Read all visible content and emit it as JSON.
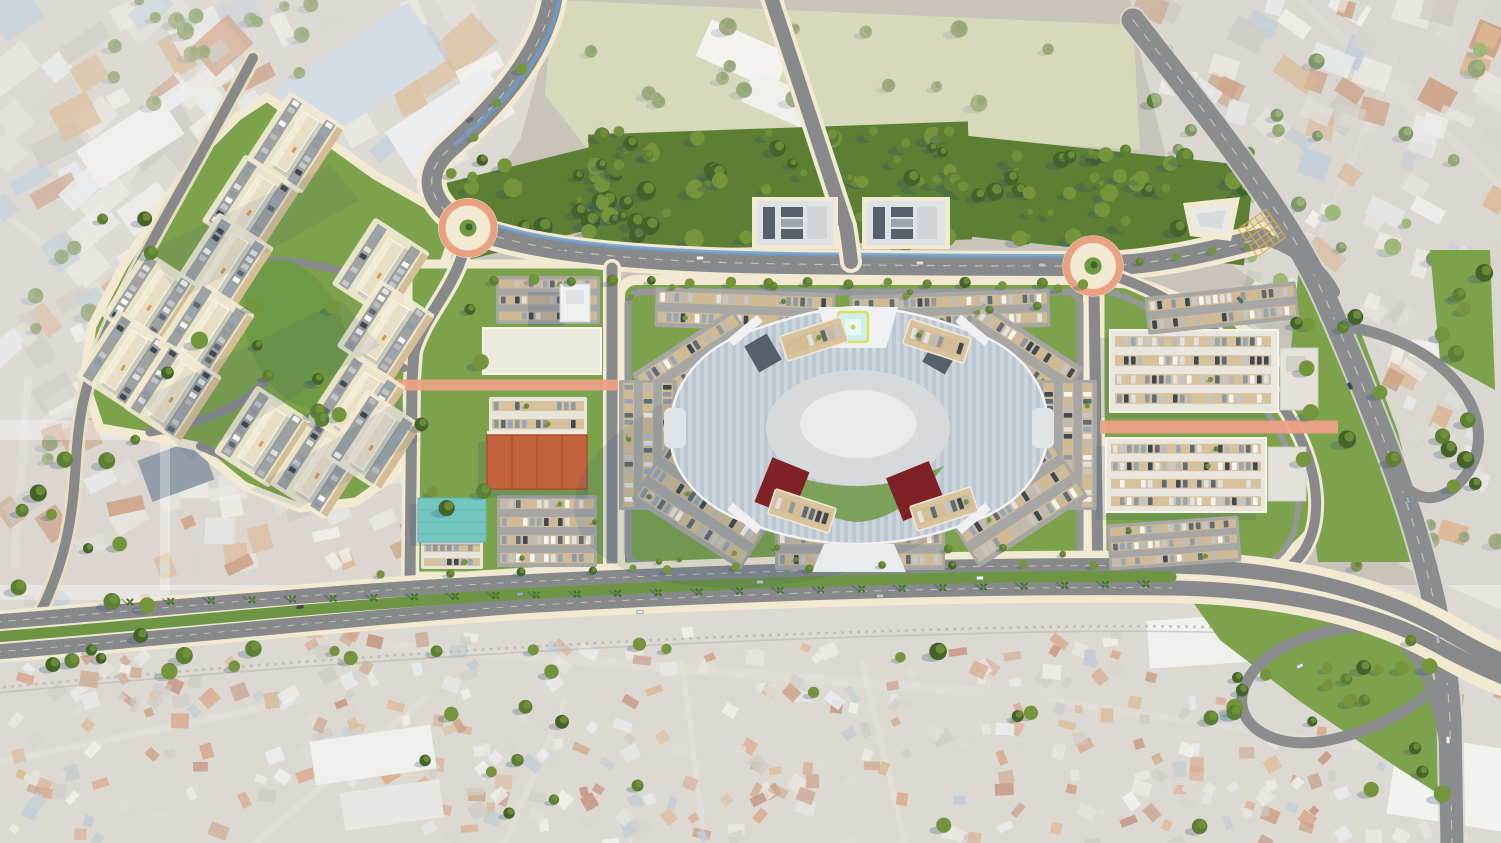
{
  "scene": {
    "title": "Aerial masterplan rendering of a mixed-use retail and residential development",
    "type": "3d-render-site-plan",
    "view": "top-down aerial",
    "no_visible_text": true,
    "width": 1501,
    "height": 843
  },
  "palette": {
    "base": "#c9c4ba",
    "field": "#c6cb9d",
    "lawn": "#7ca24b",
    "lawnDark": "#6f9a45",
    "median": "#6d9544",
    "forestFloor": "#5d7f33",
    "cream": "#f1e9d2",
    "creamSoft": "#e9dfc2",
    "asphalt": "#87898b",
    "asphaltLight": "#95979a",
    "asphaltDark": "#797b7e",
    "highway": "#8a8c8e",
    "roadEdge": "#d8d8d4",
    "cycleBlue": "#6f9cc9",
    "roundRing": "#e9a181",
    "salmon": "#eba184",
    "parkAsphalt": "#a6a7a5",
    "stallTan": "#d4bd94",
    "deckTan": "#d8c49c",
    "mallStripeA": "#bcc6d0",
    "mallStripeB": "#cdd5dc",
    "mallParapet": "#f0f2f4",
    "courtyard": "#d7dadd",
    "courtyardLight": "#e9eaec",
    "entryWhite": "#eef0f2",
    "redAnchor": "#7e2125",
    "slateRoof": "#55606b",
    "slateLight": "#7b8691",
    "tealRoof": "#74c7c1",
    "bigboxOrange": "#c2633e",
    "bigboxRidge": "#a94f30",
    "whiteBldg": "#eceada",
    "whiteRoof": "#e8e6df",
    "beigeBldg": "#e8dec6",
    "beigeLight": "#f2ebd8",
    "plotBldg": "#dfe2e4",
    "helipadTeal": "#cdeeea",
    "helipadYellow": "#d9e05e",
    "shadow": "#2d4b73",
    "hazeWhite": "#ffffff",
    "rail": "#8a8a82",
    "hatchYellow": "#d4b04e",
    "existRoad": "#d9d6ce",
    "treeForest1": "#44632a",
    "treeForest2": "#5d7f33",
    "treeForest3": "#74953c",
    "treeOlive1": "#6b7a3a",
    "treeOlive2": "#7d8a4e",
    "palmGreen": "#3f6d2a"
  },
  "features": {
    "shopping_mall": {
      "shape": "elongated hexagonal ring",
      "roof": "striped blue-grey",
      "central_courtyard": true,
      "helipad": true,
      "red_anchor_roofs": 2,
      "rooftop_parking_decks": 4
    },
    "roundabouts": 2,
    "pedestrian_corridors_salmon": 2,
    "residential_compound_clusters": 13,
    "office_plots_north": 2,
    "big_box_store_orange_roof": 1,
    "market_teal_roof": 1,
    "tower_building_west_of_mall": 1,
    "right_parking_structures": 2,
    "highway_interchange_loops": 2,
    "tree_lined_boulevard_with_cycleway": true,
    "palm_median_avenue": true,
    "existing_city": [
      "industrial zone north-west",
      "green field north-centre",
      "urban blocks north-east",
      "dense informal neighbourhood south",
      "railway along south avenue"
    ]
  },
  "generators": {
    "seed": 1337,
    "carColors": [
      "#f5f5f3",
      "#dfe1e3",
      "#c3c7cc",
      "#8f99a3",
      "#5d6a77",
      "#3c4855",
      "#93a7b8",
      "#b9babc"
    ],
    "existPalette": [
      "#eceae4",
      "#e0ddd5",
      "#d2cfc7",
      "#c4c0b6",
      "#b5b1a7",
      "#a4b7c6",
      "#dfe3e6",
      "#c9955f",
      "#b4744b"
    ],
    "favelaPalette": [
      "#eceae4",
      "#e0ddd5",
      "#cfccc4",
      "#c4c0b6",
      "#c9955f",
      "#b4744b",
      "#a85f41",
      "#c77b52",
      "#dfe3e6",
      "#9fb0bd",
      "#b5b1a7",
      "#c77b52"
    ],
    "cityBlocks": [
      {
        "t": "gCityTL",
        "r": [
          0,
          0,
          250,
          430
        ],
        "n": 60,
        "smin": 14,
        "smax": 52,
        "a": -33,
        "j": 10,
        "p": "exist"
      },
      {
        "t": "gCityTL",
        "r": [
          150,
          0,
          340,
          160
        ],
        "n": 34,
        "smin": 14,
        "smax": 56,
        "a": -33,
        "j": 10,
        "p": "exist"
      },
      {
        "t": "gCityTL",
        "r": [
          0,
          290,
          130,
          270
        ],
        "n": 24,
        "smin": 12,
        "smax": 40,
        "a": -25,
        "j": 14,
        "p": "exist"
      },
      {
        "t": "gCityLeft",
        "r": [
          160,
          440,
          250,
          130
        ],
        "n": 36,
        "smin": 10,
        "smax": 34,
        "a": -15,
        "j": 20,
        "p": "exist"
      },
      {
        "t": "gCityTR",
        "r": [
          1150,
          0,
          351,
          130
        ],
        "n": 38,
        "smin": 12,
        "smax": 44,
        "a": 25,
        "j": 12,
        "p": "exist"
      },
      {
        "t": "gCityTR",
        "r": [
          1250,
          80,
          251,
          280
        ],
        "n": 52,
        "smin": 10,
        "smax": 38,
        "a": 25,
        "j": 14,
        "p": "exist"
      },
      {
        "t": "gCityTR",
        "r": [
          1360,
          300,
          141,
          270
        ],
        "n": 24,
        "smin": 10,
        "smax": 32,
        "a": 25,
        "j": 16,
        "p": "exist"
      },
      {
        "t": "gFavela",
        "r": [
          0,
          598,
          360,
          245
        ],
        "n": 120,
        "smin": 7,
        "smax": 20,
        "a": -10,
        "j": 45,
        "p": "favela"
      },
      {
        "t": "gFavela",
        "r": [
          340,
          632,
          820,
          211
        ],
        "n": 230,
        "smin": 7,
        "smax": 19,
        "a": 10,
        "j": 45,
        "p": "favela"
      },
      {
        "t": "gFavela",
        "r": [
          1120,
          690,
          381,
          153
        ],
        "n": 80,
        "smin": 7,
        "smax": 19,
        "a": 15,
        "j": 45,
        "p": "favela"
      }
    ],
    "treeRects": [
      {
        "t": "gForestTrees",
        "r": [
          448,
          160,
          190,
          80
        ],
        "n": 26,
        "k": "forest"
      },
      {
        "t": "gForestTrees",
        "r": [
          590,
          128,
          380,
          118
        ],
        "n": 56,
        "k": "forest"
      },
      {
        "t": "gForestTrees",
        "r": [
          950,
          150,
          300,
          100
        ],
        "n": 40,
        "k": "forest"
      },
      {
        "t": "gTrees",
        "r": [
          240,
          270,
          120,
          150
        ],
        "n": 9,
        "k": "render"
      },
      {
        "t": "gTrees",
        "r": [
          100,
          210,
          120,
          190
        ],
        "n": 5,
        "k": "render"
      },
      {
        "t": "gTrees",
        "r": [
          415,
          300,
          70,
          240
        ],
        "n": 6,
        "k": "render"
      },
      {
        "t": "gTrees",
        "r": [
          1288,
          320,
          60,
          170
        ],
        "n": 6,
        "k": "render"
      },
      {
        "t": "gTrees",
        "r": [
          1335,
          300,
          150,
          190
        ],
        "n": 11,
        "k": "render"
      },
      {
        "t": "gTrees",
        "r": [
          1230,
          625,
          190,
          85
        ],
        "n": 9,
        "k": "render"
      },
      {
        "t": "gTrees",
        "r": [
          1430,
          250,
          60,
          110
        ],
        "n": 5,
        "k": "render"
      },
      {
        "t": "gTrees",
        "r": [
          30,
          640,
          920,
          38
        ],
        "n": 17,
        "k": "render"
      },
      {
        "t": "gTrees",
        "r": [
          420,
          692,
          620,
          140
        ],
        "n": 13,
        "k": "render"
      },
      {
        "t": "gTrees",
        "r": [
          1140,
          660,
          350,
          170
        ],
        "n": 13,
        "k": "render"
      },
      {
        "t": "gTrees",
        "r": [
          0,
          430,
          150,
          270
        ],
        "n": 12,
        "k": "render"
      },
      {
        "t": "gTrees",
        "r": [
          630,
          286,
          440,
          24
        ],
        "n": 8,
        "k": "small"
      },
      {
        "t": "gTrees",
        "r": [
          630,
          544,
          440,
          24
        ],
        "n": 8,
        "k": "small"
      },
      {
        "t": "gExistTrees",
        "r": [
          100,
          0,
          260,
          130
        ],
        "n": 18,
        "k": "olive"
      },
      {
        "t": "gExistTrees",
        "r": [
          0,
          240,
          150,
          230
        ],
        "n": 13,
        "k": "olive"
      },
      {
        "t": "gExistTrees",
        "r": [
          560,
          15,
          500,
          105
        ],
        "n": 16,
        "k": "olive"
      },
      {
        "t": "gExistTrees",
        "r": [
          1150,
          50,
          340,
          260
        ],
        "n": 26,
        "k": "render"
      },
      {
        "t": "gExistTrees",
        "r": [
          1350,
          430,
          150,
          170
        ],
        "n": 8,
        "k": "olive"
      }
    ],
    "streetTreeLines": [
      {
        "line": [
          495,
          281,
          1082,
          285
        ],
        "n": 16,
        "r": 4.2
      },
      {
        "line": [
          520,
          70,
          452,
          172
        ],
        "n": 4,
        "r": 4.2
      },
      {
        "line": [
          380,
          573,
          1095,
          564
        ],
        "n": 11,
        "r": 3.6
      },
      {
        "line": [
          1140,
          262,
          1248,
          246
        ],
        "n": 4,
        "r": 3.4
      }
    ],
    "palms": {
      "line": [
        130,
        602,
        1146,
        584
      ],
      "n": 26
    },
    "parking": [
      {
        "t": "gRetailPark",
        "x": 496,
        "y": 276,
        "w": 104,
        "h": 48,
        "rot": 0,
        "rows": 3,
        "bg": "lot"
      },
      {
        "t": "gRetailPark",
        "x": 484,
        "y": 330,
        "w": 116,
        "h": 44,
        "rot": 0,
        "rows": 3,
        "bg": "none"
      },
      {
        "t": "gRetailPark",
        "x": 489,
        "y": 397,
        "w": 98,
        "h": 36,
        "rot": 0,
        "rows": 2,
        "bg": "white"
      },
      {
        "t": "gRetailPark",
        "x": 497,
        "y": 495,
        "w": 100,
        "h": 72,
        "rot": 0,
        "rows": 4,
        "bg": "lot"
      },
      {
        "t": "gRetailPark",
        "x": 421,
        "y": 541,
        "w": 62,
        "h": 28,
        "rot": 0,
        "rows": 2,
        "bg": "white"
      },
      {
        "t": "gMallPark",
        "x": 655,
        "y": 290,
        "w": 180,
        "h": 40,
        "rot": 2,
        "rows": 2,
        "bg": "lot"
      },
      {
        "t": "gMallPark",
        "x": 850,
        "y": 292,
        "w": 200,
        "h": 38,
        "rot": -2,
        "rows": 2,
        "bg": "lot"
      },
      {
        "t": "gMallPark",
        "x": 640,
        "y": 336,
        "w": 120,
        "h": 66,
        "rot": -33,
        "rows": 3,
        "bg": "lot"
      },
      {
        "t": "gMallPark",
        "x": 955,
        "y": 330,
        "w": 120,
        "h": 66,
        "rot": 33,
        "rows": 3,
        "bg": "lot"
      },
      {
        "t": "gMallPark",
        "x": 583,
        "y": 416,
        "w": 130,
        "h": 58,
        "rot": 90,
        "rows": 3,
        "bg": "lot"
      },
      {
        "t": "gMallPark",
        "x": 1003,
        "y": 416,
        "w": 130,
        "h": 58,
        "rot": 90,
        "rows": 3,
        "bg": "lot"
      },
      {
        "t": "gMallPark",
        "x": 640,
        "y": 470,
        "w": 130,
        "h": 70,
        "rot": 33,
        "rows": 3,
        "bg": "lot"
      },
      {
        "t": "gMallPark",
        "x": 950,
        "y": 468,
        "w": 130,
        "h": 70,
        "rot": -33,
        "rows": 3,
        "bg": "lot"
      },
      {
        "t": "gMallPark",
        "x": 775,
        "y": 528,
        "w": 170,
        "h": 42,
        "rot": 0,
        "rows": 2,
        "bg": "lot"
      },
      {
        "t": "gMallDecks",
        "x": 782,
        "y": 326,
        "w": 64,
        "h": 26,
        "rot": -18,
        "rows": 1,
        "bg": "deck"
      },
      {
        "t": "gMallDecks",
        "x": 905,
        "y": 328,
        "w": 64,
        "h": 26,
        "rot": 18,
        "rows": 1,
        "bg": "deck"
      },
      {
        "t": "gMallDecks",
        "x": 770,
        "y": 498,
        "w": 64,
        "h": 26,
        "rot": 18,
        "rows": 1,
        "bg": "deck"
      },
      {
        "t": "gMallDecks",
        "x": 912,
        "y": 496,
        "w": 64,
        "h": 26,
        "rot": -18,
        "rows": 1,
        "bg": "deck"
      },
      {
        "t": "gRightPark",
        "x": 1146,
        "y": 289,
        "w": 152,
        "h": 38,
        "rot": -6,
        "rows": 2,
        "bg": "lot"
      },
      {
        "t": "gRightPark",
        "x": 1112,
        "y": 332,
        "w": 162,
        "h": 76,
        "rot": 0,
        "rows": 4,
        "bg": "none"
      },
      {
        "t": "gRightPark",
        "x": 1108,
        "y": 440,
        "w": 156,
        "h": 70,
        "rot": 0,
        "rows": 4,
        "bg": "none"
      },
      {
        "t": "gRightPark",
        "x": 1108,
        "y": 520,
        "w": 132,
        "h": 46,
        "rot": -4,
        "rows": 3,
        "bg": "lot"
      }
    ],
    "clusters": {
      "angle": -57,
      "centers": [
        [
          295,
          142
        ],
        [
          250,
          205
        ],
        [
          224,
          263
        ],
        [
          150,
          300
        ],
        [
          124,
          360
        ],
        [
          380,
          268
        ],
        [
          385,
          330
        ],
        [
          356,
          402
        ],
        [
          205,
          330
        ],
        [
          172,
          392
        ],
        [
          262,
          436
        ],
        [
          318,
          468
        ],
        [
          372,
          440
        ]
      ]
    },
    "cars": [
      [
        700,
        258,
        -1
      ],
      [
        920,
        263,
        0
      ],
      [
        1042,
        265,
        0
      ],
      [
        560,
        250,
        2
      ],
      [
        470,
        120,
        -35
      ],
      [
        300,
        607,
        -6
      ],
      [
        520,
        594,
        -4
      ],
      [
        760,
        582,
        -2
      ],
      [
        980,
        578,
        -1
      ],
      [
        640,
        612,
        -3
      ],
      [
        880,
        596,
        -2
      ],
      [
        1120,
        588,
        0
      ],
      [
        1240,
        300,
        48
      ],
      [
        1350,
        386,
        62
      ],
      [
        1408,
        500,
        72
      ],
      [
        1438,
        640,
        82
      ],
      [
        1448,
        740,
        87
      ],
      [
        1300,
        666,
        -25
      ]
    ]
  }
}
